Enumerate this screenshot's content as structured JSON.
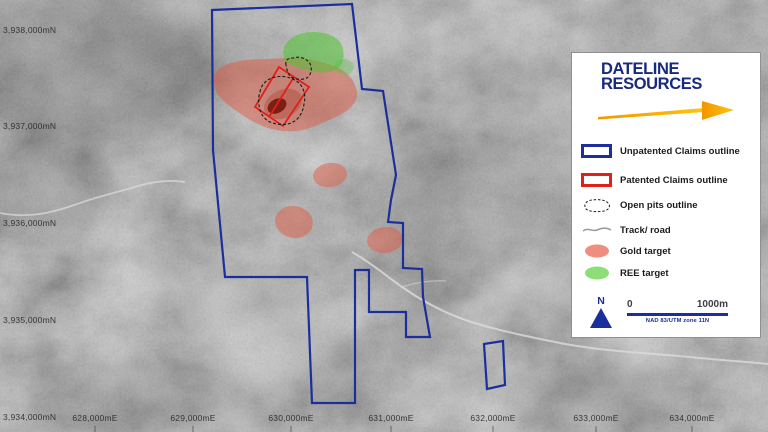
{
  "map": {
    "northings": [
      "3,938,000mN",
      "3,937,000mN",
      "3,936,000mN",
      "3,935,000mN",
      "3,934,000mN"
    ],
    "eastings": [
      "628,000mE",
      "629,000mE",
      "630,000mE",
      "631,000mE",
      "632,000mE",
      "633,000mE",
      "634,000mE"
    ]
  },
  "legend": {
    "logo_line1": "DATELINE",
    "logo_line2": "RESOURCES",
    "items": [
      {
        "label": "Unpatented Claims outline"
      },
      {
        "label": "Patented Claims outline"
      },
      {
        "label": "Open pits outline"
      },
      {
        "label": "Track/ road"
      },
      {
        "label": "Gold target"
      },
      {
        "label": "REE target"
      }
    ],
    "north_label": "N",
    "scale_start": "0",
    "scale_end": "1000m",
    "datum": "NAD 83/UTM zone 11N"
  },
  "colors": {
    "unpatented_outline": "#1b2f9c",
    "patented_outline": "#e02019",
    "open_pit_outline": "#1a1a1a",
    "gold_target": "#e05a44",
    "ree_target": "#4ec431",
    "logo_navy": "#172a7d",
    "arrow_gold": "#f9b000"
  }
}
